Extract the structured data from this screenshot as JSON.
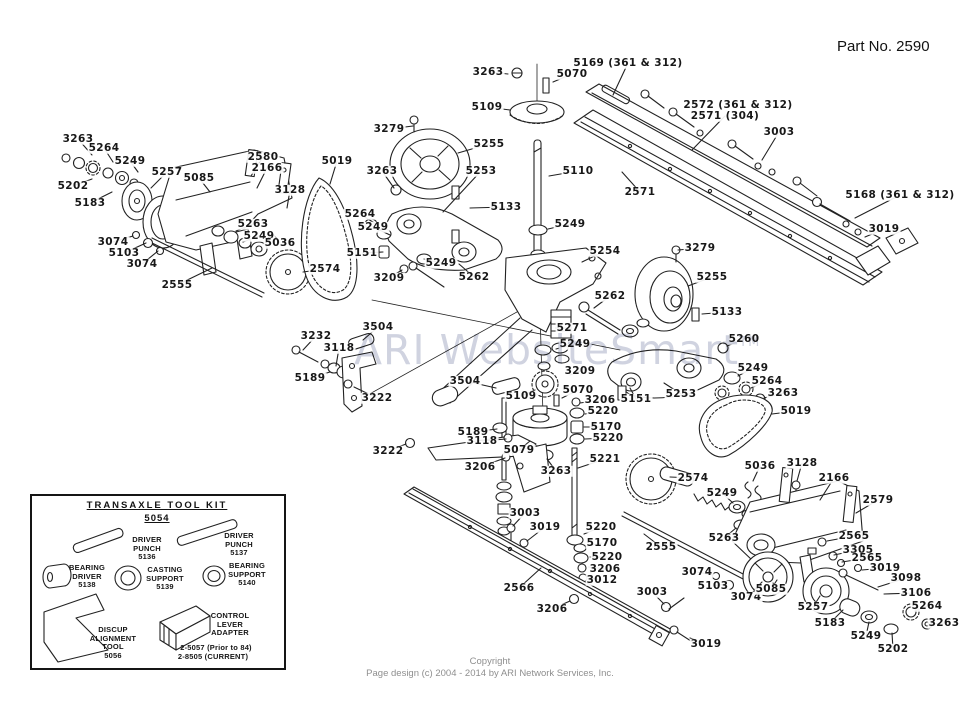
{
  "page": {
    "part_no": "Part No. 2590",
    "watermark": "ARI WebsiteSmart",
    "watermark_tm": "TM",
    "copyright_line1": "Copyright",
    "copyright_line2": "Page design (c) 2004 - 2014 by ARI Network Services, Inc."
  },
  "toolkit": {
    "title": "TRANSAXLE  TOOL  KIT",
    "subtitle": "5054",
    "items": [
      {
        "label": "DRIVER\nPUNCH\n5136",
        "x": 147,
        "y": 536
      },
      {
        "label": "DRIVER\nPUNCH\n5137",
        "x": 239,
        "y": 532
      },
      {
        "label": "BEARING\nDRIVER\n5138",
        "x": 87,
        "y": 564
      },
      {
        "label": "CASTING\nSUPPORT\n5139",
        "x": 165,
        "y": 566
      },
      {
        "label": "BEARING\nSUPPORT\n5140",
        "x": 247,
        "y": 562
      },
      {
        "label": "DISCUP\nALIGNMENT\nTOOL\n5056",
        "x": 113,
        "y": 626
      },
      {
        "label": "CONTROL\nLEVER\nADAPTER",
        "x": 230,
        "y": 612
      },
      {
        "label": "2-5057 (Prior to 84)",
        "x": 216,
        "y": 644
      },
      {
        "label": "2-8505 (CURRENT)",
        "x": 213,
        "y": 653
      }
    ]
  },
  "diagram": {
    "labels": [
      {
        "t": "3263",
        "x": 78,
        "y": 139,
        "lx": 92,
        "ly": 155
      },
      {
        "t": "5264",
        "x": 104,
        "y": 148,
        "lx": 113,
        "ly": 162
      },
      {
        "t": "5249",
        "x": 130,
        "y": 161,
        "lx": 138,
        "ly": 172
      },
      {
        "t": "5202",
        "x": 73,
        "y": 186,
        "lx": 92,
        "ly": 179
      },
      {
        "t": "5183",
        "x": 90,
        "y": 203,
        "lx": 112,
        "ly": 192
      },
      {
        "t": "5257",
        "x": 167,
        "y": 172,
        "lx": 151,
        "ly": 188
      },
      {
        "t": "5085",
        "x": 199,
        "y": 178,
        "lx": 210,
        "ly": 192
      },
      {
        "t": "2580",
        "x": 263,
        "y": 157,
        "lx": 251,
        "ly": 176
      },
      {
        "t": "2166",
        "x": 267,
        "y": 168,
        "lx": 257,
        "ly": 188
      },
      {
        "t": "3128",
        "x": 290,
        "y": 190,
        "lx": 287,
        "ly": 208
      },
      {
        "t": "5019",
        "x": 337,
        "y": 161,
        "lx": 330,
        "ly": 184
      },
      {
        "t": "3074",
        "x": 113,
        "y": 242,
        "lx": 133,
        "ly": 236
      },
      {
        "t": "5103",
        "x": 124,
        "y": 253,
        "lx": 146,
        "ly": 243
      },
      {
        "t": "3074",
        "x": 142,
        "y": 264,
        "lx": 158,
        "ly": 251
      },
      {
        "t": "2555",
        "x": 177,
        "y": 285,
        "lx": 212,
        "ly": 268
      },
      {
        "t": "5263",
        "x": 253,
        "y": 224,
        "lx": 236,
        "ly": 231
      },
      {
        "t": "5249",
        "x": 259,
        "y": 236,
        "lx": 243,
        "ly": 242
      },
      {
        "t": "5036",
        "x": 280,
        "y": 243,
        "lx": 273,
        "ly": 234
      },
      {
        "t": "2574",
        "x": 325,
        "y": 269,
        "lx": 303,
        "ly": 272
      },
      {
        "t": "3263",
        "x": 488,
        "y": 72,
        "lx": 508,
        "ly": 74
      },
      {
        "t": "5070",
        "x": 572,
        "y": 74,
        "lx": 553,
        "ly": 82
      },
      {
        "t": "5169 (361 & 312)",
        "x": 628,
        "y": 63,
        "lx": 613,
        "ly": 95
      },
      {
        "t": "5109",
        "x": 487,
        "y": 107,
        "lx": 510,
        "ly": 110
      },
      {
        "t": "2572 (361 & 312)",
        "x": 738,
        "y": 105,
        "lx": null,
        "ly": null
      },
      {
        "t": "2571 (304)",
        "x": 725,
        "y": 116,
        "lx": 692,
        "ly": 150
      },
      {
        "t": "3003",
        "x": 779,
        "y": 132,
        "lx": 762,
        "ly": 160
      },
      {
        "t": "2571",
        "x": 640,
        "y": 192,
        "lx": 622,
        "ly": 172
      },
      {
        "t": "5168 (361 & 312)",
        "x": 900,
        "y": 195,
        "lx": 855,
        "ly": 218
      },
      {
        "t": "3019",
        "x": 884,
        "y": 229,
        "lx": 865,
        "ly": 237
      },
      {
        "t": "3279",
        "x": 389,
        "y": 129,
        "lx": 413,
        "ly": 126
      },
      {
        "t": "5255",
        "x": 489,
        "y": 144,
        "lx": 458,
        "ly": 153
      },
      {
        "t": "3263",
        "x": 382,
        "y": 171,
        "lx": 394,
        "ly": 188
      },
      {
        "t": "5253",
        "x": 481,
        "y": 171,
        "lx": 443,
        "ly": 212
      },
      {
        "t": "5110",
        "x": 578,
        "y": 171,
        "lx": 549,
        "ly": 176
      },
      {
        "t": "5133",
        "x": 506,
        "y": 207,
        "lx": 470,
        "ly": 208
      },
      {
        "t": "5264",
        "x": 360,
        "y": 214,
        "lx": 376,
        "ly": 224
      },
      {
        "t": "5249",
        "x": 373,
        "y": 227,
        "lx": 390,
        "ly": 235
      },
      {
        "t": "5249",
        "x": 570,
        "y": 224,
        "lx": 548,
        "ly": 229
      },
      {
        "t": "5151",
        "x": 362,
        "y": 253,
        "lx": 383,
        "ly": 252
      },
      {
        "t": "3209",
        "x": 389,
        "y": 278,
        "lx": 402,
        "ly": 270
      },
      {
        "t": "5249",
        "x": 441,
        "y": 263,
        "lx": 424,
        "ly": 259
      },
      {
        "t": "5262",
        "x": 474,
        "y": 277,
        "lx": 459,
        "ly": 264
      },
      {
        "t": "5254",
        "x": 605,
        "y": 251,
        "lx": 582,
        "ly": 262
      },
      {
        "t": "3279",
        "x": 700,
        "y": 248,
        "lx": 678,
        "ly": 250
      },
      {
        "t": "5255",
        "x": 712,
        "y": 277,
        "lx": 688,
        "ly": 286
      },
      {
        "t": "5262",
        "x": 610,
        "y": 296,
        "lx": 594,
        "ly": 308
      },
      {
        "t": "5133",
        "x": 727,
        "y": 312,
        "lx": 702,
        "ly": 314
      },
      {
        "t": "5260",
        "x": 744,
        "y": 339,
        "lx": 727,
        "ly": 346
      },
      {
        "t": "5249",
        "x": 753,
        "y": 368,
        "lx": 738,
        "ly": 376
      },
      {
        "t": "5264",
        "x": 767,
        "y": 381,
        "lx": 751,
        "ly": 388
      },
      {
        "t": "3263",
        "x": 783,
        "y": 393,
        "lx": 764,
        "ly": 398
      },
      {
        "t": "5019",
        "x": 796,
        "y": 411,
        "lx": 772,
        "ly": 414
      },
      {
        "t": "5253",
        "x": 681,
        "y": 394,
        "lx": 664,
        "ly": 383
      },
      {
        "t": "5151",
        "x": 636,
        "y": 399,
        "lx": 630,
        "ly": 388
      },
      {
        "t": "5271",
        "x": 572,
        "y": 328,
        "lx": 556,
        "ly": 328
      },
      {
        "t": "5249",
        "x": 575,
        "y": 344,
        "lx": 556,
        "ly": 349
      },
      {
        "t": "3209",
        "x": 580,
        "y": 371,
        "lx": 570,
        "ly": 375
      },
      {
        "t": "5070",
        "x": 578,
        "y": 390,
        "lx": 562,
        "ly": 398
      },
      {
        "t": "3206",
        "x": 600,
        "y": 400,
        "lx": 580,
        "ly": 403
      },
      {
        "t": "5220",
        "x": 603,
        "y": 411,
        "lx": 585,
        "ly": 414
      },
      {
        "t": "5170",
        "x": 606,
        "y": 427,
        "lx": 584,
        "ly": 427
      },
      {
        "t": "5220",
        "x": 608,
        "y": 438,
        "lx": 585,
        "ly": 439
      },
      {
        "t": "5109",
        "x": 521,
        "y": 396,
        "lx": 535,
        "ly": 390
      },
      {
        "t": "5079",
        "x": 519,
        "y": 450,
        "lx": 530,
        "ly": 441
      },
      {
        "t": "3263",
        "x": 556,
        "y": 471,
        "lx": 547,
        "ly": 459
      },
      {
        "t": "5221",
        "x": 605,
        "y": 459,
        "lx": 578,
        "ly": 468
      },
      {
        "t": "3232",
        "x": 316,
        "y": 336,
        "lx": 303,
        "ly": 350
      },
      {
        "t": "3118",
        "x": 339,
        "y": 348,
        "lx": 336,
        "ly": 366
      },
      {
        "t": "3504",
        "x": 378,
        "y": 327,
        "lx": 363,
        "ly": 340
      },
      {
        "t": "5189",
        "x": 310,
        "y": 378,
        "lx": 330,
        "ly": 372
      },
      {
        "t": "3222",
        "x": 377,
        "y": 398,
        "lx": 354,
        "ly": 387
      },
      {
        "t": "3504",
        "x": 465,
        "y": 381,
        "lx": 496,
        "ly": 388
      },
      {
        "t": "5189",
        "x": 473,
        "y": 432,
        "lx": 497,
        "ly": 429
      },
      {
        "t": "3118",
        "x": 482,
        "y": 441,
        "lx": 506,
        "ly": 439
      },
      {
        "t": "3222",
        "x": 388,
        "y": 451,
        "lx": 406,
        "ly": 444
      },
      {
        "t": "3206",
        "x": 480,
        "y": 467,
        "lx": 505,
        "ly": 458
      },
      {
        "t": "3003",
        "x": 525,
        "y": 513,
        "lx": 513,
        "ly": 526
      },
      {
        "t": "3019",
        "x": 545,
        "y": 527,
        "lx": 527,
        "ly": 541
      },
      {
        "t": "5220",
        "x": 601,
        "y": 527,
        "lx": 584,
        "ly": 534
      },
      {
        "t": "5170",
        "x": 602,
        "y": 543,
        "lx": 587,
        "ly": 546
      },
      {
        "t": "5220",
        "x": 607,
        "y": 557,
        "lx": 590,
        "ly": 557
      },
      {
        "t": "3206",
        "x": 605,
        "y": 569,
        "lx": 589,
        "ly": 567
      },
      {
        "t": "3012",
        "x": 602,
        "y": 580,
        "lx": 590,
        "ly": 578
      },
      {
        "t": "2566",
        "x": 519,
        "y": 588,
        "lx": 541,
        "ly": 568
      },
      {
        "t": "3206",
        "x": 552,
        "y": 609,
        "lx": 570,
        "ly": 601
      },
      {
        "t": "2555",
        "x": 661,
        "y": 547,
        "lx": 644,
        "ly": 534
      },
      {
        "t": "3003",
        "x": 652,
        "y": 592,
        "lx": 664,
        "ly": 604
      },
      {
        "t": "3019",
        "x": 706,
        "y": 644,
        "lx": 690,
        "ly": 638
      },
      {
        "t": "2574",
        "x": 693,
        "y": 478,
        "lx": 670,
        "ly": 477
      },
      {
        "t": "5036",
        "x": 760,
        "y": 466,
        "lx": 753,
        "ly": 481
      },
      {
        "t": "3128",
        "x": 802,
        "y": 463,
        "lx": 797,
        "ly": 481
      },
      {
        "t": "2166",
        "x": 834,
        "y": 478,
        "lx": 820,
        "ly": 500
      },
      {
        "t": "2579",
        "x": 878,
        "y": 500,
        "lx": 856,
        "ly": 513
      },
      {
        "t": "5249",
        "x": 722,
        "y": 493,
        "lx": 733,
        "ly": 503
      },
      {
        "t": "5263",
        "x": 724,
        "y": 538,
        "lx": 736,
        "ly": 528
      },
      {
        "t": "2565",
        "x": 854,
        "y": 536,
        "lx": 827,
        "ly": 541
      },
      {
        "t": "3305",
        "x": 858,
        "y": 550,
        "lx": 834,
        "ly": 555
      },
      {
        "t": "2565",
        "x": 867,
        "y": 558,
        "lx": 842,
        "ly": 562
      },
      {
        "t": "3019",
        "x": 885,
        "y": 568,
        "lx": 862,
        "ly": 570
      },
      {
        "t": "3098",
        "x": 906,
        "y": 578,
        "lx": 878,
        "ly": 587
      },
      {
        "t": "3106",
        "x": 916,
        "y": 593,
        "lx": 884,
        "ly": 594
      },
      {
        "t": "3074",
        "x": 697,
        "y": 572,
        "lx": 713,
        "ly": 575
      },
      {
        "t": "5103",
        "x": 713,
        "y": 586,
        "lx": 726,
        "ly": 584
      },
      {
        "t": "3074",
        "x": 746,
        "y": 597,
        "lx": 756,
        "ly": 590
      },
      {
        "t": "5085",
        "x": 771,
        "y": 589,
        "lx": 777,
        "ly": 580
      },
      {
        "t": "5257",
        "x": 813,
        "y": 607,
        "lx": 820,
        "ly": 596
      },
      {
        "t": "5183",
        "x": 830,
        "y": 623,
        "lx": 843,
        "ly": 610
      },
      {
        "t": "5249",
        "x": 866,
        "y": 636,
        "lx": 869,
        "ly": 622
      },
      {
        "t": "5202",
        "x": 893,
        "y": 649,
        "lx": 892,
        "ly": 633
      },
      {
        "t": "5264",
        "x": 927,
        "y": 606,
        "lx": 915,
        "ly": 611
      },
      {
        "t": "3263",
        "x": 944,
        "y": 623,
        "lx": 931,
        "ly": 624
      }
    ]
  }
}
